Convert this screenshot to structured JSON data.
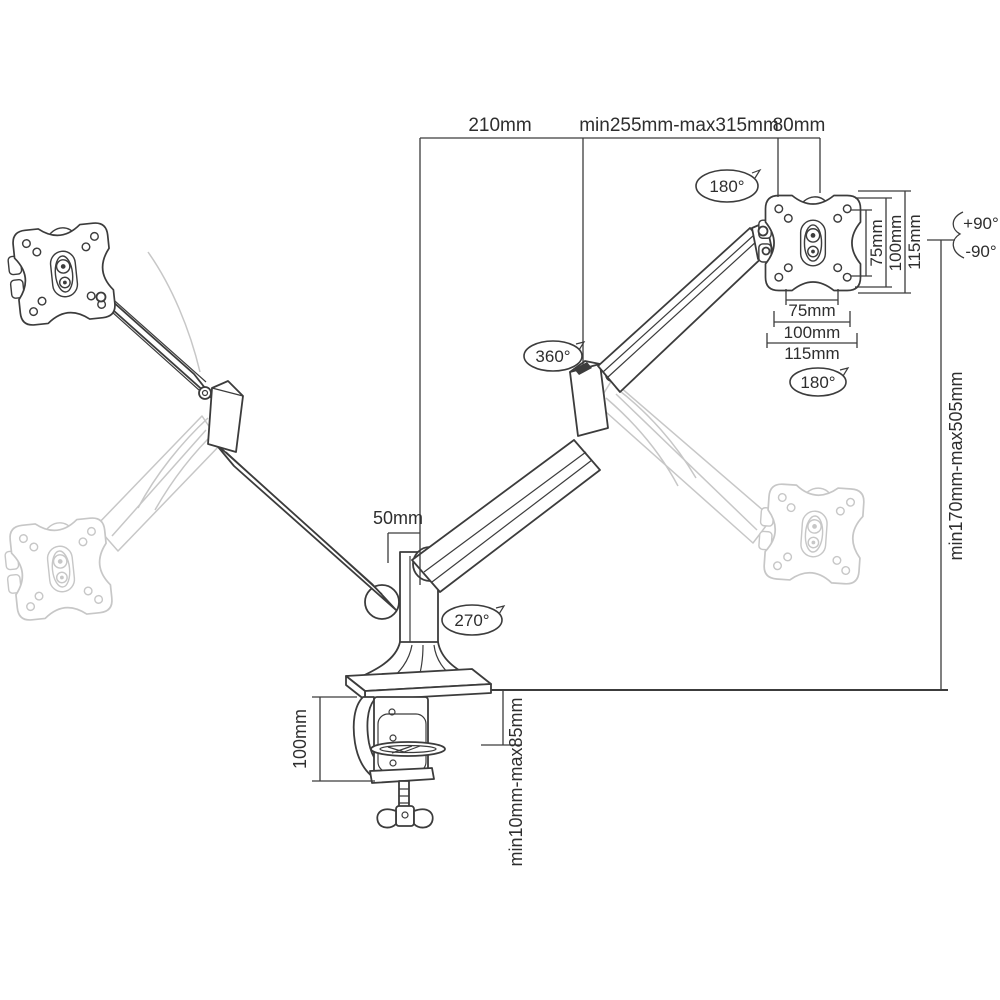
{
  "diagram": {
    "type": "technical-drawing",
    "subject": "dual-arm gas-spring desk monitor mount with dimensions",
    "colors": {
      "line": "#3c3c3c",
      "ghost": "#c7c7c7",
      "text": "#2e2e2e",
      "bg": "#ffffff"
    },
    "dimensions": {
      "top_arm_offset": "210mm",
      "top_arm_extension": "min255mm-max315mm",
      "top_plate_depth": "80mm",
      "pole_offset": "50mm",
      "height_range": "min170mm-max505mm",
      "vesa_vertical_75": "75mm",
      "vesa_vertical_100": "100mm",
      "vesa_vertical_115": "115mm",
      "vesa_horizontal_75": "75mm",
      "vesa_horizontal_100": "100mm",
      "vesa_horizontal_115": "115mm",
      "clamp_height": "100mm",
      "clamp_desk_range": "min10mm-max85mm"
    },
    "rotations": {
      "arm_swivel_top": "180°",
      "plate_rotation": "180°",
      "elbow_swivel": "360°",
      "base_swivel": "270°",
      "tilt_up": "+90°",
      "tilt_down": "-90°"
    }
  }
}
